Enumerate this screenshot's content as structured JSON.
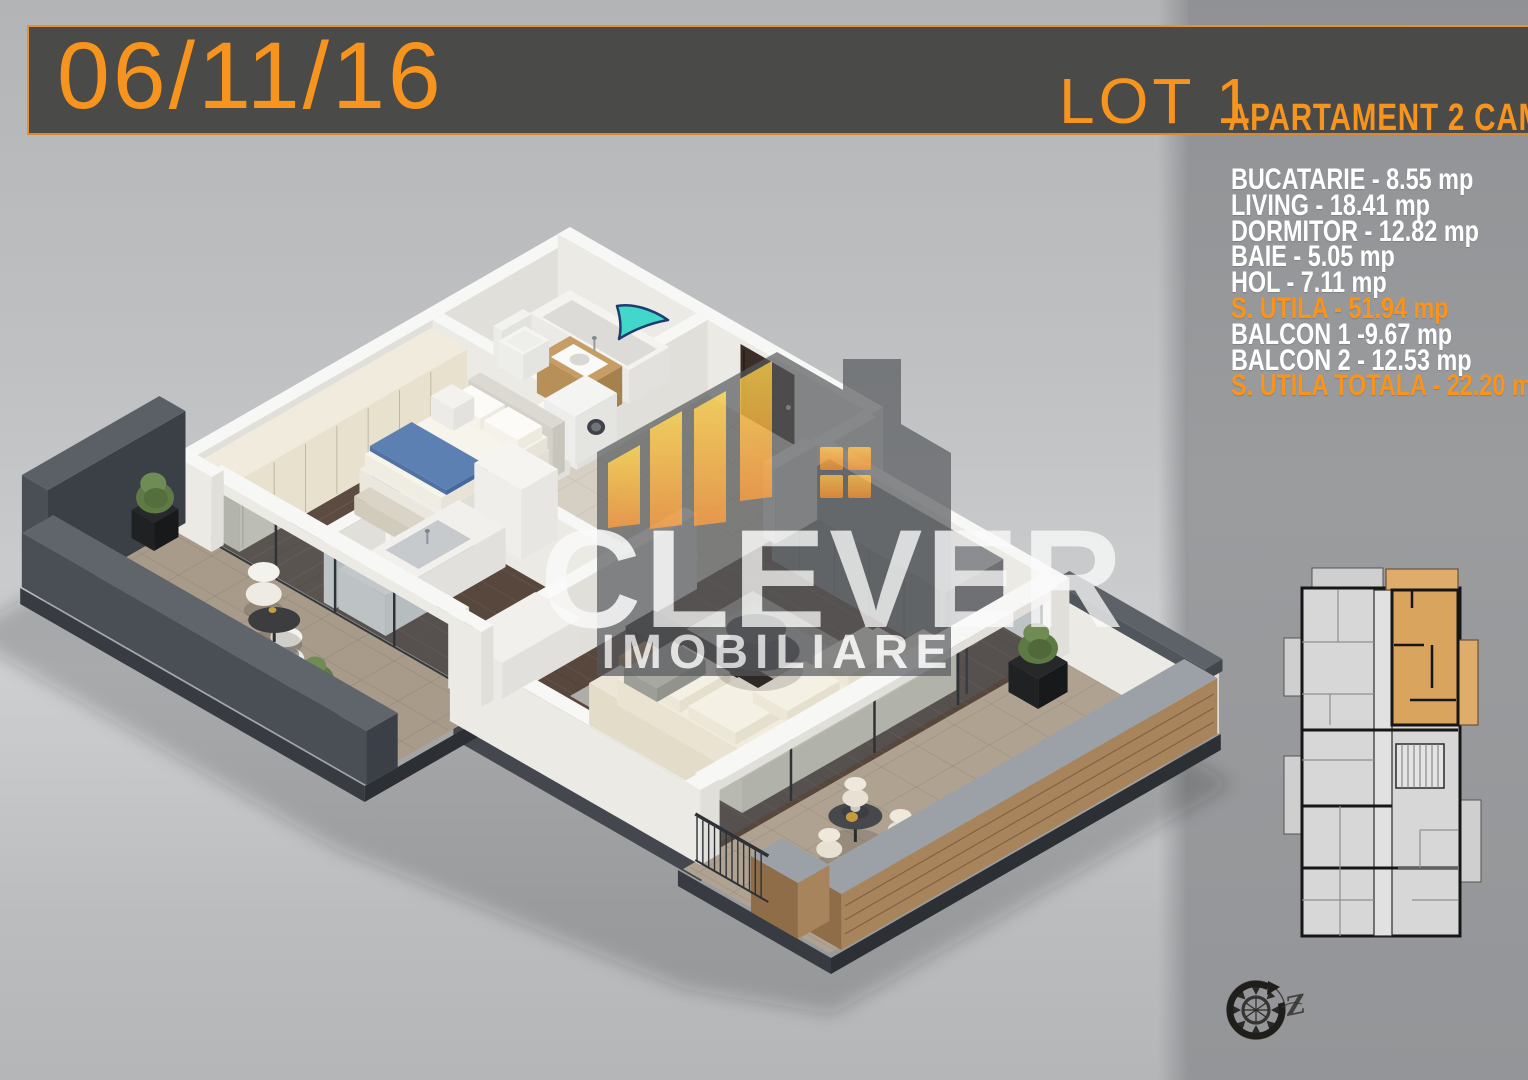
{
  "banner": {
    "date": "06/11/16",
    "lot": "LOT 1",
    "subtitle": "APARTAMENT 2 CAMERE"
  },
  "areas": {
    "items": [
      {
        "name": "BUCATARIE",
        "area": "8.55",
        "unit": "mp",
        "text": "BUCATARIE - 8.55 mp",
        "highlight": false
      },
      {
        "name": "LIVING",
        "area": "18.41",
        "unit": "mp",
        "text": "LIVING - 18.41 mp",
        "highlight": false
      },
      {
        "name": "DORMITOR",
        "area": "12.82",
        "unit": "mp",
        "text": "DORMITOR - 12.82 mp",
        "highlight": false
      },
      {
        "name": "BAIE",
        "area": "5.05",
        "unit": "mp",
        "text": "BAIE - 5.05 mp",
        "highlight": false
      },
      {
        "name": "HOL",
        "area": "7.11",
        "unit": "mp",
        "text": "HOL - 7.11 mp",
        "highlight": false
      },
      {
        "name": "S. UTILA",
        "area": "51.94",
        "unit": "mp",
        "text": "S. UTILA - 51.94 mp",
        "highlight": true
      },
      {
        "name": "BALCON 1",
        "area": "9.67",
        "unit": "mp",
        "text": "BALCON 1 -9.67 mp",
        "highlight": false
      },
      {
        "name": "BALCON 2",
        "area": "12.53",
        "unit": "mp",
        "text": "BALCON 2 - 12.53 mp",
        "highlight": false
      },
      {
        "name": "S. UTILA TOTALA",
        "area": "22.20",
        "unit": "mp",
        "text": "S. UTILA TOTALA - 22.20 mp",
        "highlight": true
      }
    ]
  },
  "watermark": {
    "name": "CLEVER",
    "tagline": "IMOBILIARE"
  },
  "compass": {
    "letter": "Z"
  },
  "colors": {
    "accent_orange": "#f7941e",
    "banner_bg": "#4a4a49",
    "right_panel_bg": "#97999b",
    "unit_highlight": "#d9a45d",
    "arrow_teal": "#41d7ca"
  }
}
